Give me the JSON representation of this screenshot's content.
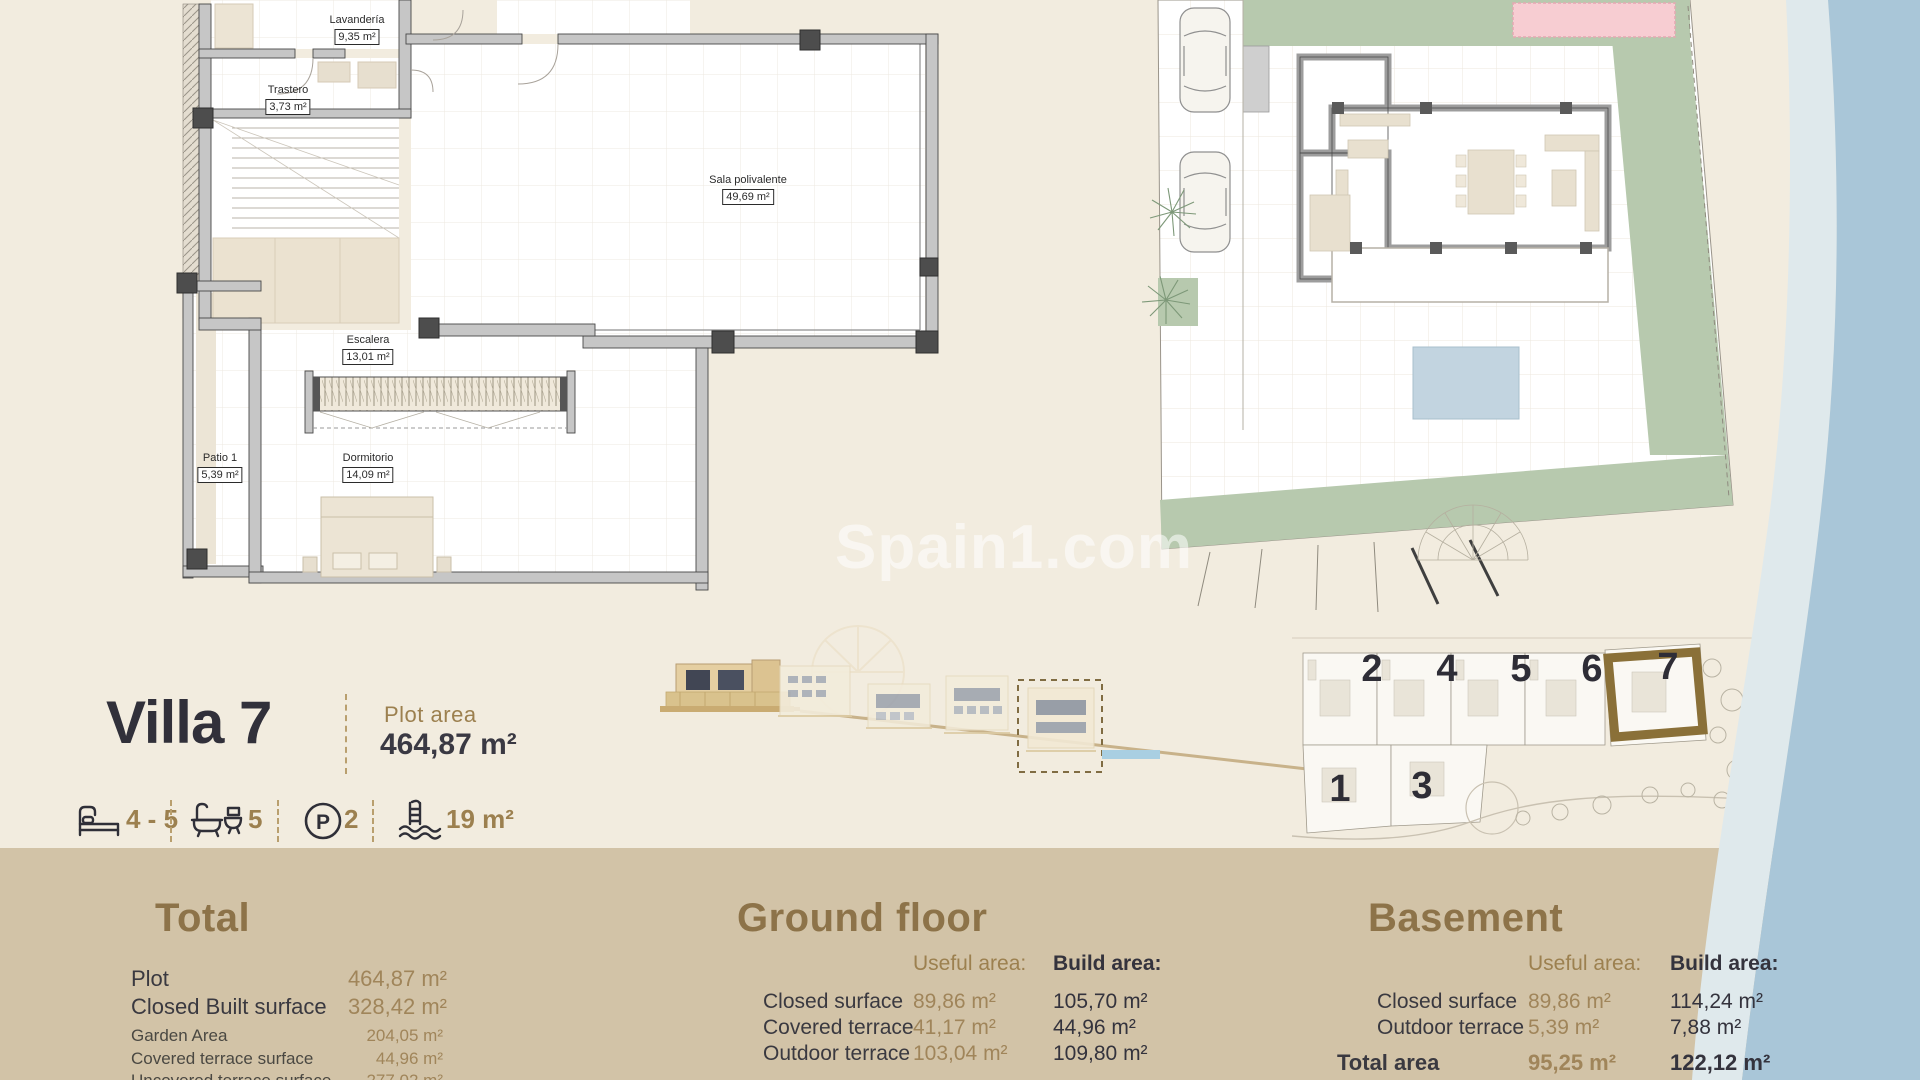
{
  "watermark": {
    "text": "Spain1.com"
  },
  "header": {
    "title": "Villa 7",
    "plot_area_label": "Plot area",
    "plot_area_value": "464,87  m²",
    "features": {
      "beds": "4 - 5",
      "baths": "5",
      "parking": "2",
      "pool": "19 m²"
    }
  },
  "basement_plan": {
    "rooms": [
      {
        "name": "Lavandería",
        "area": "9,35 m²"
      },
      {
        "name": "Trastero",
        "area": "3,73 m²"
      },
      {
        "name": "Sala polivalente",
        "area": "49,69 m²"
      },
      {
        "name": "Escalera",
        "area": "13,01 m²"
      },
      {
        "name": "Patio 1",
        "area": "5,39 m²"
      },
      {
        "name": "Dormitorio",
        "area": "14,09 m²"
      }
    ]
  },
  "site_overview": {
    "numbers": {
      "top": [
        "2",
        "4",
        "5",
        "6",
        "7"
      ],
      "bottom": [
        "1",
        "3"
      ]
    },
    "highlighted_plot": "7"
  },
  "sections": {
    "total": {
      "title": "Total",
      "rows": [
        {
          "label": "Plot",
          "value": "464,87 m²"
        },
        {
          "label": "Closed Built surface",
          "value": "328,42 m²"
        },
        {
          "label": "Garden Area",
          "value": "204,05 m²"
        },
        {
          "label": "Covered terrace surface",
          "value": "44,96  m²"
        },
        {
          "label": "Uncovered terrace surface",
          "value": "277,02 m²"
        }
      ]
    },
    "ground_floor": {
      "title": "Ground floor",
      "columns": {
        "useful": "Useful  area:",
        "build": "Build area:"
      },
      "rows": [
        {
          "label": "Closed surface",
          "useful": "89,86 m²",
          "build": "105,70 m²"
        },
        {
          "label": "Covered terrace",
          "useful": "41,17 m²",
          "build": "44,96 m²"
        },
        {
          "label": "Outdoor terrace",
          "useful": "103,04 m²",
          "build": "109,80 m²"
        }
      ]
    },
    "basement": {
      "title": "Basement",
      "columns": {
        "useful": "Useful  area:",
        "build": "Build area:"
      },
      "rows": [
        {
          "label": "Closed surface",
          "useful": "89,86 m²",
          "build": "114,24 m²"
        },
        {
          "label": "Outdoor terrace",
          "useful": "5,39 m²",
          "build": "7,88 m²"
        }
      ],
      "total_row": {
        "label": "Total area",
        "useful": "95,25 m²",
        "build": "122,12 m²"
      }
    }
  },
  "colors": {
    "background_top": "#f2ecdf",
    "background_bottom": "#d2c3a7",
    "accent_gold": "#9c804f",
    "text_dark": "#34333d",
    "sea": "#a9c6d8",
    "beach": "#dfe9ec",
    "garden_green": "#b7c9ae",
    "pool_pink": "#f7cdd2"
  }
}
